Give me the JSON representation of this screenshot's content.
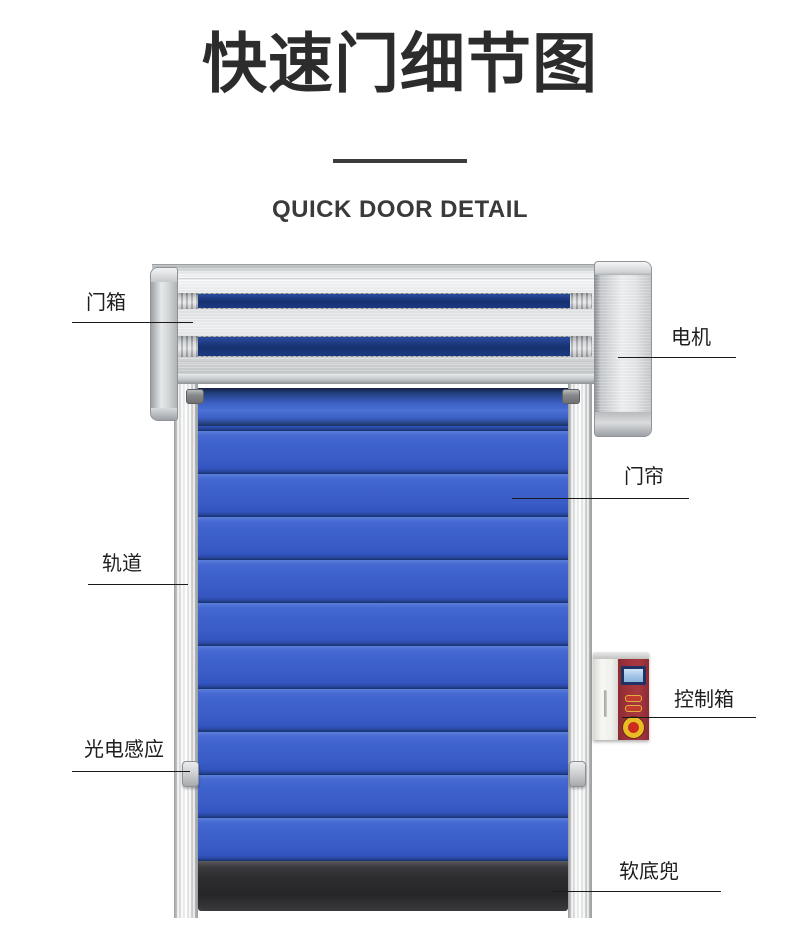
{
  "page": {
    "title": "快速门细节图",
    "subtitle": "QUICK DOOR DETAIL"
  },
  "callouts": [
    {
      "id": "door-box",
      "label": "门箱"
    },
    {
      "id": "motor",
      "label": "电机"
    },
    {
      "id": "curtain",
      "label": "门帘"
    },
    {
      "id": "track",
      "label": "轨道"
    },
    {
      "id": "control-box",
      "label": "控制箱"
    },
    {
      "id": "photo-sensor",
      "label": "光电感应"
    },
    {
      "id": "bottom-bag",
      "label": "软底兜"
    }
  ],
  "colors": {
    "title_color": "#2c2c2c",
    "divider_color": "#3c3c3c",
    "text_color": "#1e1e1e",
    "line_color": "#1a1a1a",
    "curtain_blue": "#3a5cc6",
    "slot_navy": "#16316f",
    "control_red": "#9d323a",
    "screen_blue": "#9fc2e6",
    "estop_yellow": "#e8bc25",
    "estop_red": "#cf2a1f",
    "bag_dark": "#262629"
  }
}
